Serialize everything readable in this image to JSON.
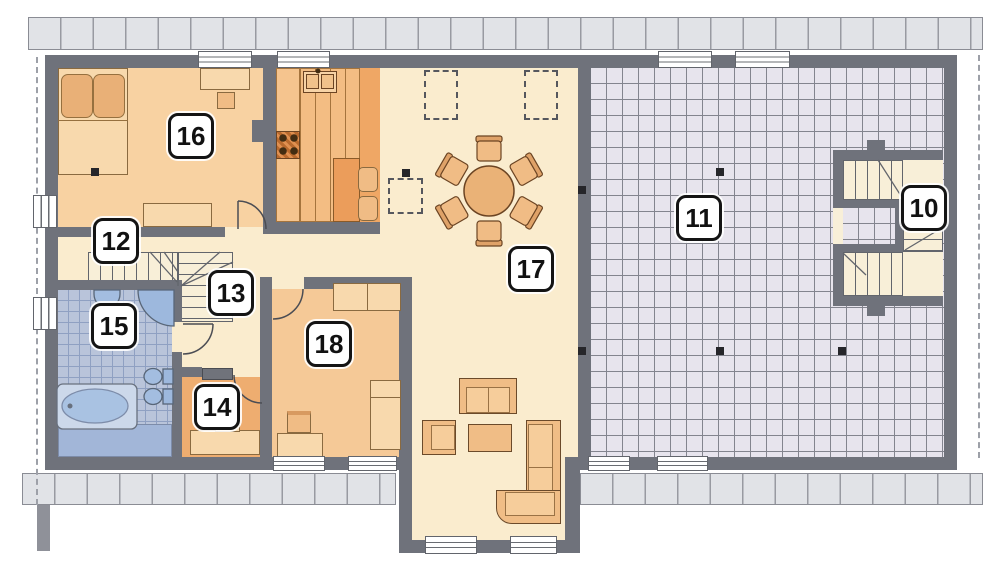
{
  "plan": {
    "rooms": [
      {
        "number": "10"
      },
      {
        "number": "11"
      },
      {
        "number": "12"
      },
      {
        "number": "13"
      },
      {
        "number": "14"
      },
      {
        "number": "15"
      },
      {
        "number": "16"
      },
      {
        "number": "17"
      },
      {
        "number": "18"
      }
    ]
  },
  "colors": {
    "wall": "#6f727b",
    "roof_overhang": "#e1e3e7",
    "floor_cream": "#faecce",
    "floor_bedroom16": "#f8d2a2",
    "floor_kitchen": "#efa765",
    "floor_bedroom18": "#f5c997",
    "floor_wardrobe14": "#eead70",
    "bathroom_tile": "#b9c4da",
    "attic_grid": "#e7e4ed",
    "furniture_wood": "#f0bc85",
    "fixture_blue": "#a3bde0",
    "label_bg": "#ffffff",
    "label_border": "#141414"
  }
}
